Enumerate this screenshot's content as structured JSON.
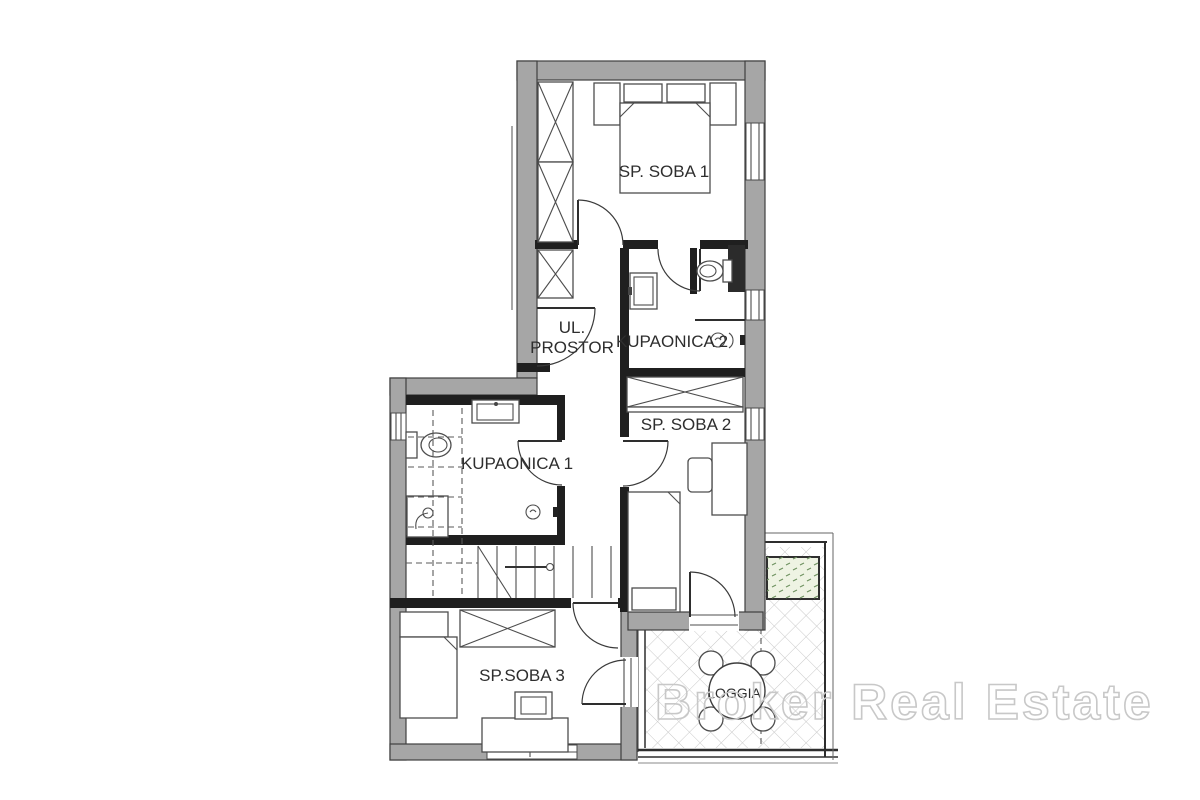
{
  "rooms": {
    "sp_soba_1": {
      "label": "SP. SOBA 1"
    },
    "ul_prostor": {
      "label_line1": "UL.",
      "label_line2": "PROSTOR"
    },
    "kupaonica_2": {
      "label": "KUPAONICA 2"
    },
    "sp_soba_2": {
      "label": "SP. SOBA 2"
    },
    "kupaonica_1": {
      "label": "KUPAONICA 1"
    },
    "sp_soba_3": {
      "label": "SP.SOBA 3"
    },
    "loggia": {
      "label": "LOGGIA"
    }
  },
  "watermark": {
    "text": "Broker Real Estate",
    "color": "#c8c8c8"
  },
  "colors": {
    "background": "#ffffff",
    "wall_fill": "#a6a6a6",
    "wall_outline": "#3f3f3f",
    "interior_wall": "#1f1f1f",
    "furniture_line": "#4d4d4d",
    "tile_line": "#c9c9c9",
    "planter_fill": "#eef3e3",
    "planter_dot": "#6f9260",
    "label_text": "#2e2e2e"
  }
}
